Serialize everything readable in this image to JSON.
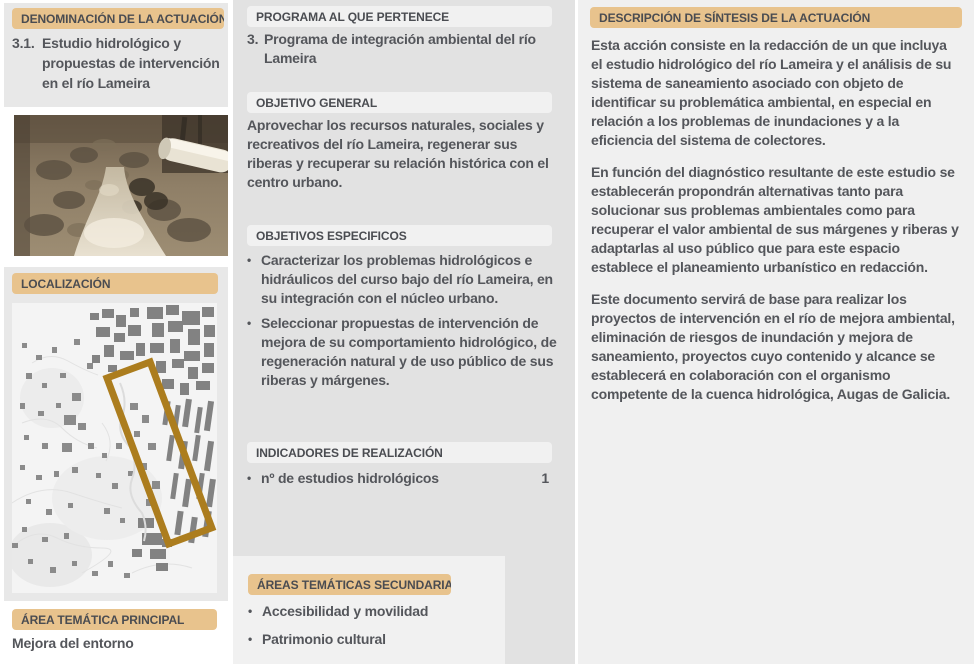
{
  "ui": {
    "bullet_glyph": "•"
  },
  "colors": {
    "accent_tan": "#e8c38d",
    "panel_gray_left": "#e8e8e8",
    "panel_gray_middle": "#e2e2e2",
    "panel_light_right": "#f0f0f0",
    "text_dark_gray": "#54565b",
    "map_highlight_gold": "#ac7d1e"
  },
  "left": {
    "denominacion": {
      "header": "DENOMINACIÓN DE LA ACTUACIÓN",
      "code": "3.1.",
      "title": "Estudio hidrológico y propuestas de intervención en el río Lameira"
    },
    "localizacion": {
      "header": "LOCALIZACIÓN"
    },
    "area_tematica_principal": {
      "header": "ÁREA TEMÁTICA PRINCIPAL",
      "value": "Mejora del entorno"
    }
  },
  "middle": {
    "programa": {
      "header": "PROGRAMA AL QUE PERTENECE",
      "code": "3.",
      "text": "Programa de integración ambiental del río Lameira"
    },
    "objetivo_general": {
      "header": "OBJETIVO GENERAL",
      "text": "Aprovechar los recursos naturales, sociales y recreativos del río Lameira, regenerar sus riberas y recuperar su relación histórica con el centro urbano."
    },
    "objetivos_especificos": {
      "header": "OBJETIVOS ESPECIFICOS",
      "items": [
        "Caracterizar los problemas hidrológicos e hidráulicos del curso bajo del río Lameira, en su integración con el núcleo urbano.",
        "Seleccionar propuestas de intervención de mejora de su comportamiento hidrológico, de regeneración natural y de uso público de sus riberas y márgenes."
      ]
    },
    "indicadores": {
      "header": "INDICADORES DE REALIZACIÓN",
      "items": [
        {
          "label": "nº de estudios hidrológicos",
          "value": "1"
        }
      ]
    },
    "areas_secundarias": {
      "header": "ÁREAS TEMÁTICAS SECUNDARIAS",
      "items": [
        "Accesibilidad y movilidad",
        "Patrimonio cultural"
      ]
    }
  },
  "right": {
    "descripcion": {
      "header": "DESCRIPCIÓN DE SÍNTESIS DE LA ACTUACIÓN",
      "paragraphs": [
        "Esta acción consiste en la redacción de un que incluya el estudio hidrológico del río Lameira y el análisis de su sistema de saneamiento asociado con objeto de identificar su problemática ambiental, en especial en relación a los problemas de inundaciones y a la eficiencia del sistema de colectores.",
        "En función del diagnóstico resultante de este estudio se establecerán propondrán alternativas tanto para solucionar sus problemas ambientales como para recuperar el valor ambiental de sus márgenes y riberas y adaptarlas al uso público que para este espacio establece el planeamiento urbanístico en redacción.",
        "Este documento servirá de base para realizar los proyectos de intervención en el río de mejora ambiental, eliminación de riesgos de inundación y mejora de saneamiento, proyectos cuyo contenido y alcance se establecerá en colaboración con el organismo competente de la cuenca hidrológica, Augas de Galicia."
      ]
    }
  }
}
